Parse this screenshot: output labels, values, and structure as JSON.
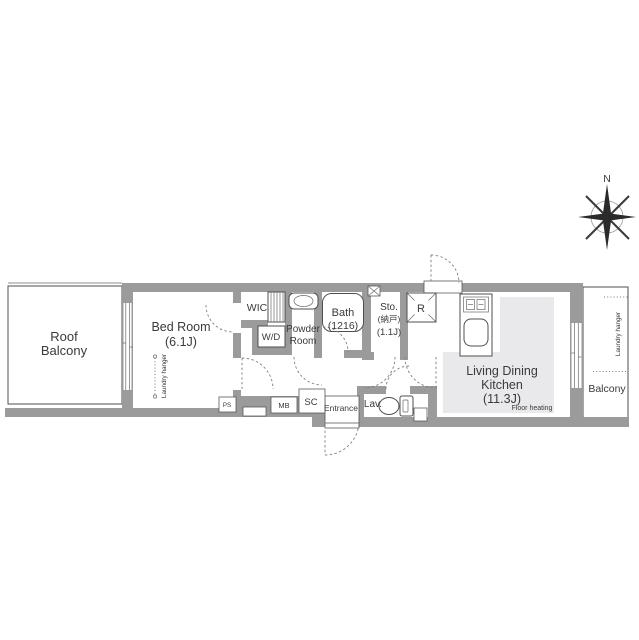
{
  "plan": {
    "compass": {
      "north": "N"
    },
    "labels": {
      "roof_balcony_1": "Roof",
      "roof_balcony_2": "Balcony",
      "bed_room_1": "Bed Room",
      "bed_room_2": "(6.1J)",
      "laundry_hanger_bedroom": "Laundry hanger",
      "wic": "WIC",
      "wd": "W/D",
      "powder_1": "Powder",
      "powder_2": "Room",
      "bath_1": "Bath",
      "bath_2": "(1216)",
      "sto_1": "Sto.",
      "sto_2": "(納戸)",
      "sto_3": "(1.1J)",
      "refrigerator": "R",
      "ldk_1": "Living Dining",
      "ldk_2": "Kitchen",
      "ldk_3": "(11.3J)",
      "floor_heating": "Floor heating",
      "balcony": "Balcony",
      "laundry_hanger_balcony": "Laundry hanger",
      "entrance": "Entrance",
      "lav": "Lav.",
      "sc": "SC",
      "mb": "MB",
      "ps": "PS"
    },
    "colors": {
      "wall": "#9b9b9b",
      "floor_heating": "#e9e9ec",
      "line": "#4f4f4f",
      "text": "#3a3a3a"
    }
  }
}
